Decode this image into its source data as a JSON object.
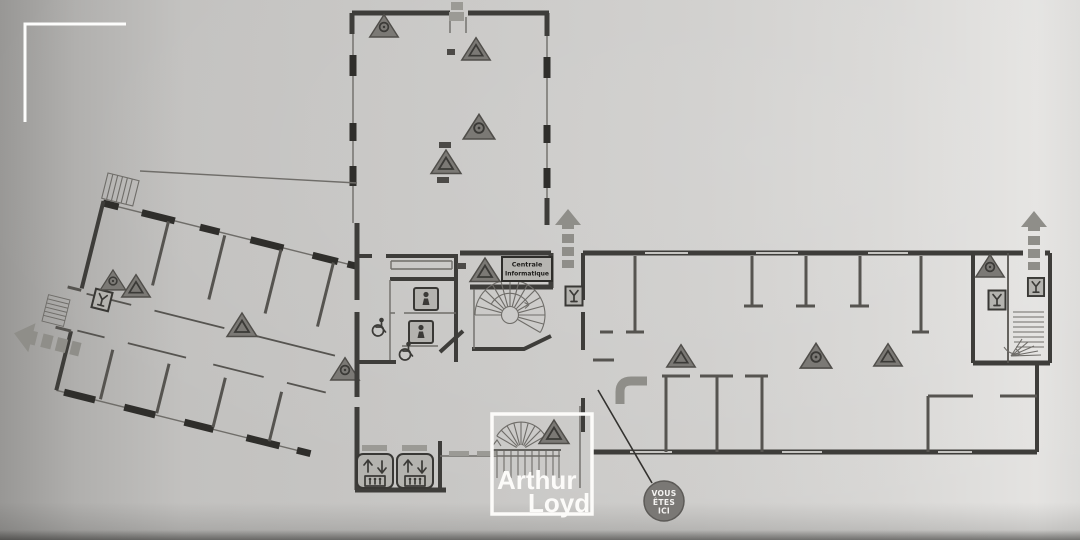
{
  "colors": {
    "paper": "#c9c8c6",
    "paper_left": "#989795",
    "paper_right": "#e4e3e1",
    "wall": "#3e3d3a",
    "wall2": "#565450",
    "thin": "#6f6d69",
    "pier": "#2f2e2b",
    "tick": "#c6c5c2",
    "tri_fill": "#7b7975",
    "tri_edge": "#504e4a",
    "glyph": "#3b3a37",
    "arrow": "#8f8e89",
    "box_fill": "#b4b3af",
    "box_edge": "#393835",
    "door": "#9b9a95",
    "label_bg": "#b6b5b1",
    "label_edge": "#2e2d2a",
    "label_text": "#1e1d1b",
    "yah_fill": "#7a7875",
    "yah_edge": "#5c5a57",
    "yah_text": "#f4f3f1",
    "logo": "#fcfbf9",
    "mark": "#4c4a47",
    "leader": "#33322f",
    "bracket": "#fdfdfc"
  },
  "labels": {
    "room": {
      "line1": "Centrale",
      "line2": "Informatique"
    },
    "you_are_here": {
      "line1": "VOUS",
      "line2": "ÊTES",
      "line3": "ICI"
    },
    "logo": {
      "line1": "Arthur",
      "line2": "Loyd"
    }
  },
  "icons": {
    "warning-triangle-icon": "▲",
    "fire-call-point-icon": "Y",
    "exit-arrow-icon": "⇧",
    "elevator-icon": "↑↓",
    "toilet-icon": "🚻",
    "wheelchair-icon": "♿",
    "stairs-icon": "☰",
    "spiral-stairs-icon": "◔",
    "you-are-here-marker": "●",
    "crop-corner-icon": "⌐"
  }
}
